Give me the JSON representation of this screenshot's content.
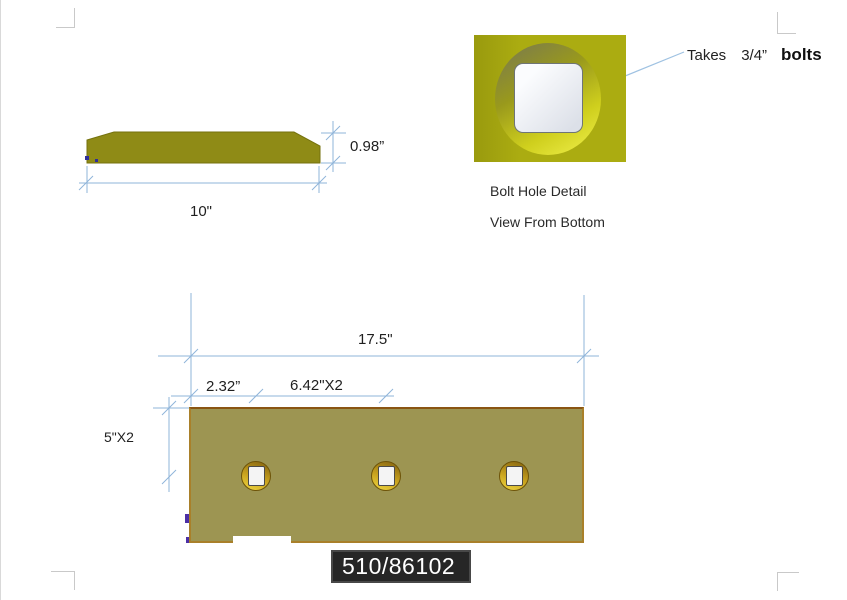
{
  "document": {
    "type": "technical-drawing",
    "part_number": "510/86102"
  },
  "side_view": {
    "thickness_label": "0.98”",
    "width_label": "10\""
  },
  "detail_view": {
    "note": {
      "takes": "Takes",
      "size": "3/4”",
      "bolts": "bolts"
    },
    "caption_line1": "Bolt Hole Detail",
    "caption_line2": "View From Bottom"
  },
  "plate_view": {
    "length_label": "17.5\"",
    "edge_offset_label": "2.32”",
    "hole_spacing_label": "6.42\"X2",
    "width_label": "5\"X2",
    "hole_count": 3
  },
  "colors": {
    "dimension_line": "#8fb4d9",
    "side_profile_fill": "#8f8b16",
    "plate_fill": "#9d9552",
    "plate_border": "#a9802a",
    "detail_square_fill": "#abac11",
    "hole_ring": "#c9a31f",
    "label_background": "#262626",
    "label_text": "#ffffff"
  }
}
